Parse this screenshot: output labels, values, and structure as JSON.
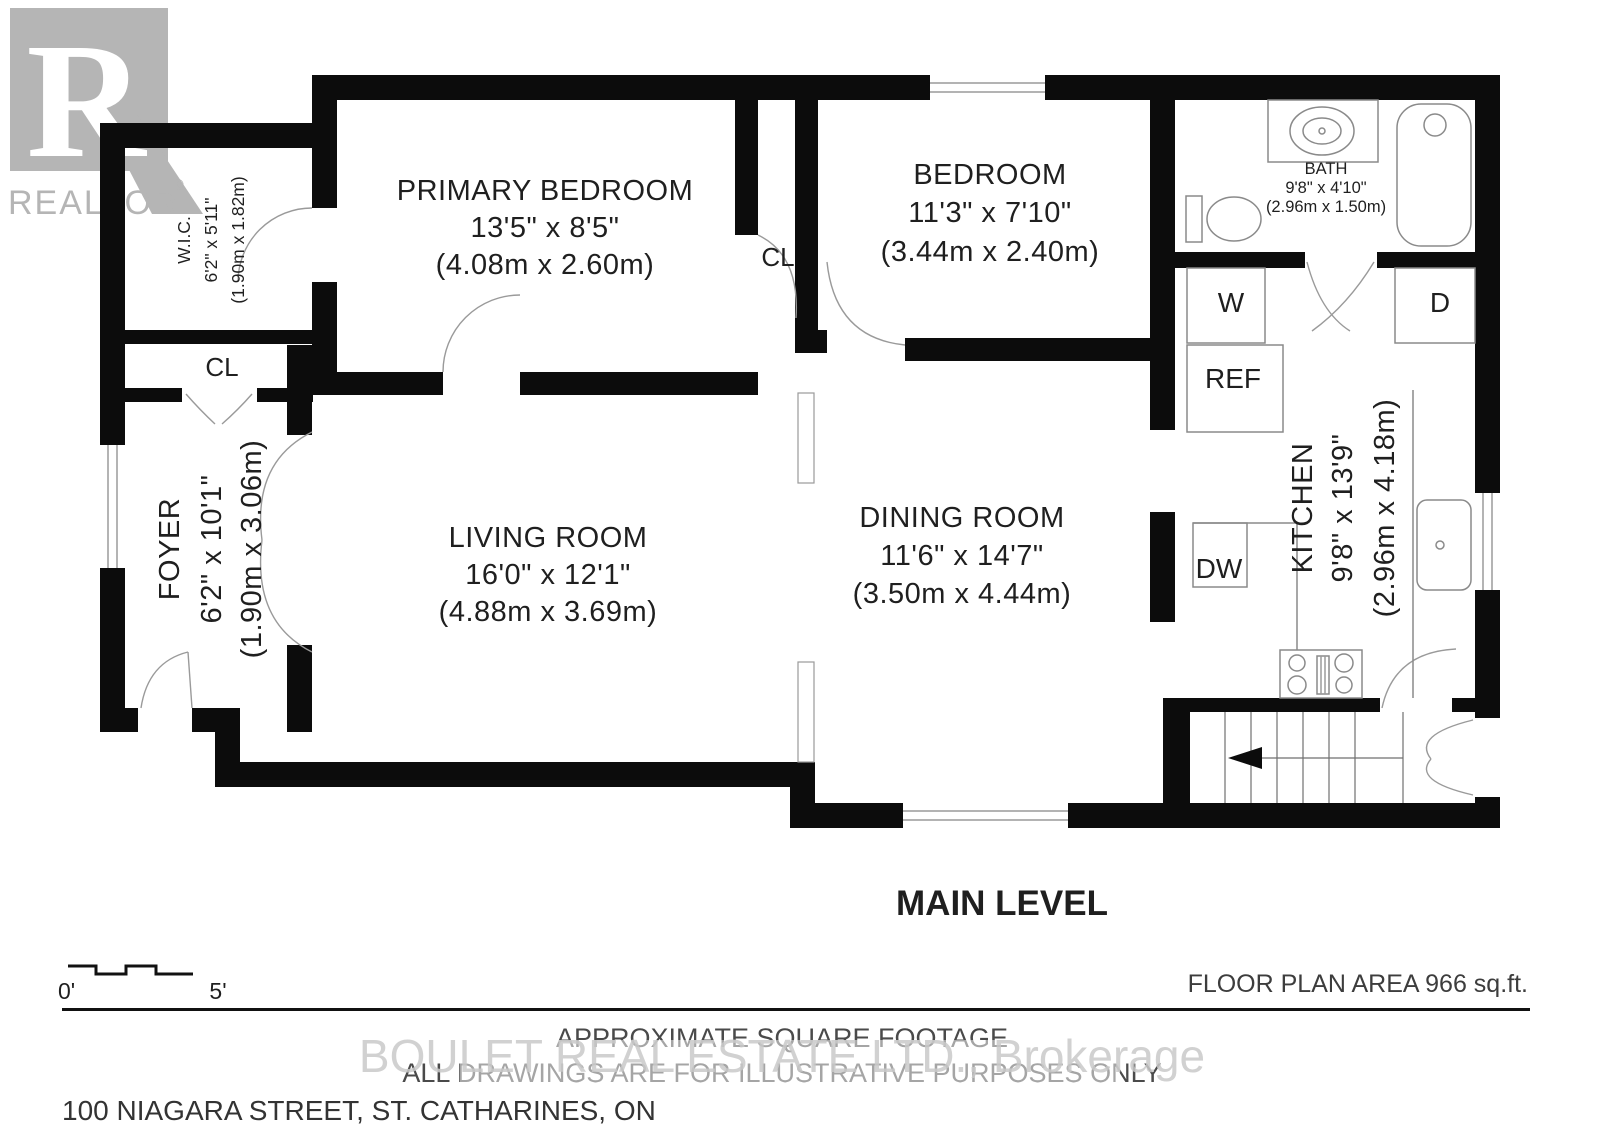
{
  "logo": {
    "letter": "R",
    "brand": "REALTOR",
    "registered": "®"
  },
  "rooms": {
    "wic": {
      "name": "W.I.C.",
      "dims_ft": "6'2\" x 5'11\"",
      "dims_m": "(1.90m x 1.82m)"
    },
    "primary_bedroom": {
      "name": "PRIMARY BEDROOM",
      "dims_ft": "13'5\" x 8'5\"",
      "dims_m": "(4.08m x 2.60m)"
    },
    "bedroom": {
      "name": "BEDROOM",
      "dims_ft": "11'3\" x 7'10\"",
      "dims_m": "(3.44m x 2.40m)"
    },
    "bath": {
      "name": "BATH",
      "dims_ft": "9'8\" x 4'10\"",
      "dims_m": "(2.96m x 1.50m)"
    },
    "foyer": {
      "name": "FOYER",
      "dims_ft": "6'2\" x 10'1\"",
      "dims_m": "(1.90m x 3.06m)"
    },
    "living_room": {
      "name": "LIVING ROOM",
      "dims_ft": "16'0\" x 12'1\"",
      "dims_m": "(4.88m x 3.69m)"
    },
    "dining_room": {
      "name": "DINING ROOM",
      "dims_ft": "11'6\" x 14'7\"",
      "dims_m": "(3.50m x 4.44m)"
    },
    "kitchen": {
      "name": "KITCHEN",
      "dims_ft": "9'8\" x 13'9\"",
      "dims_m": "(2.96m x 4.18m)"
    }
  },
  "fixtures": {
    "closet_wic": "CL",
    "closet_hall": "CL",
    "washer": "W",
    "dryer": "D",
    "refrigerator": "REF",
    "dishwasher": "DW"
  },
  "titles": {
    "level": "MAIN LEVEL",
    "floor_area": "FLOOR PLAN AREA 966 sq.ft."
  },
  "scale_bar": {
    "start": "0'",
    "end": "5'"
  },
  "footer": {
    "line1": "APPROXIMATE SQUARE FOOTAGE",
    "line2": "ALL DRAWINGS ARE FOR ILLUSTRATIVE PURPOSES ONLY",
    "address": "100 NIAGARA STREET, ST. CATHARINES, ON",
    "watermark": "BOULET REAL ESTATE LTD., Brokerage"
  },
  "colors": {
    "wall": "#0c0c0c",
    "text": "#1f1f1f",
    "muted": "#4a4a4a",
    "logo_gray": "#b5b5b5",
    "watermark": "#c9c9c9"
  }
}
